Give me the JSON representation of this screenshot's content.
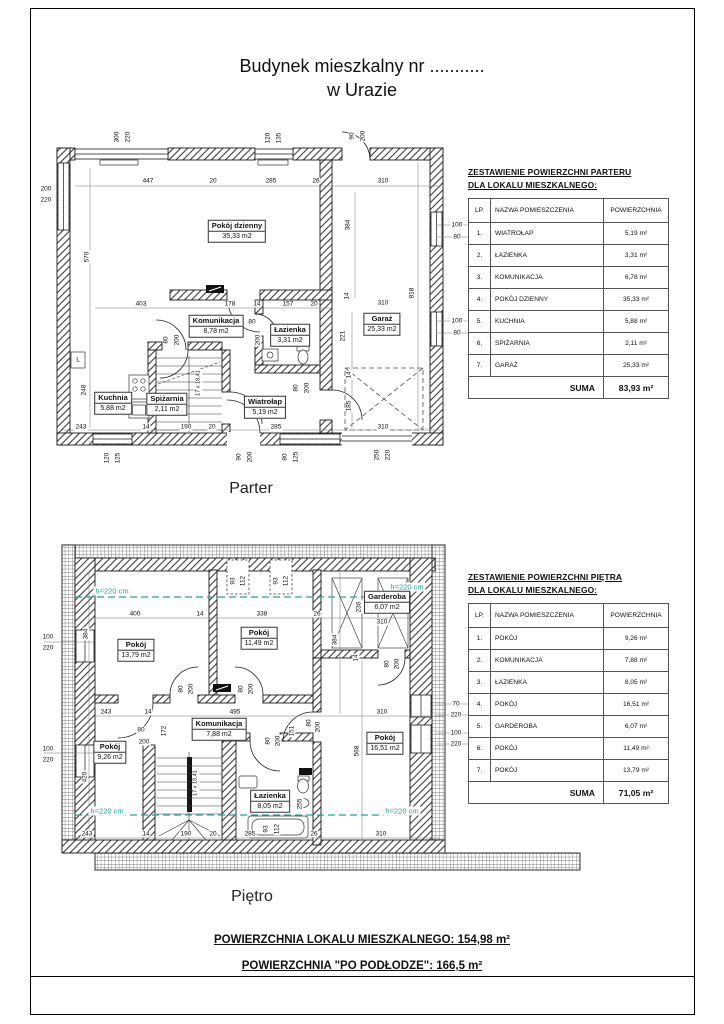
{
  "page": {
    "title_line1": "Budynek mieszkalny nr ...........",
    "title_line2": "w Urazie",
    "summary_line1": "POWIERZCHNIA LOKALU MIESZKALNEGO: 154,98 m²",
    "summary_line2": "POWIERZCHNIA \"PO PODŁODZE\": 166,5 m²"
  },
  "colors": {
    "annotation_teal": "#2aa098",
    "line_black": "#1a1a1a"
  },
  "floors": [
    {
      "id": "parter",
      "label": "Parter",
      "rooms": [
        {
          "name": "Pokój dzienny",
          "area": "35,33 m2",
          "x": 237,
          "y": 231
        },
        {
          "name": "Komunikacja",
          "area": "8,78 m2",
          "x": 216,
          "y": 326
        },
        {
          "name": "Łazienka",
          "area": "3,31 m2",
          "x": 290,
          "y": 335
        },
        {
          "name": "Garaż",
          "area": "25,33 m2",
          "x": 382,
          "y": 324
        },
        {
          "name": "Kuchnia",
          "area": "5,88 m2",
          "x": 113,
          "y": 403
        },
        {
          "name": "Spiżarnia",
          "area": "2,11 m2",
          "x": 167,
          "y": 404
        },
        {
          "name": "Wiatrołap",
          "area": "5,19 m2",
          "x": 265,
          "y": 407
        }
      ],
      "dims": [
        {
          "t": "300",
          "x": 117,
          "y": 137,
          "r": 90
        },
        {
          "t": "220",
          "x": 128,
          "y": 137,
          "r": 90
        },
        {
          "t": "120",
          "x": 268,
          "y": 138,
          "r": 90
        },
        {
          "t": "135",
          "x": 279,
          "y": 138,
          "r": 90
        },
        {
          "t": "90",
          "x": 352,
          "y": 136,
          "r": 90
        },
        {
          "t": "200",
          "x": 363,
          "y": 136,
          "r": 90
        },
        {
          "t": "447",
          "x": 148,
          "y": 181
        },
        {
          "t": "20",
          "x": 213,
          "y": 181
        },
        {
          "t": "285",
          "x": 271,
          "y": 181
        },
        {
          "t": "26",
          "x": 316,
          "y": 181
        },
        {
          "t": "310",
          "x": 383,
          "y": 181
        },
        {
          "t": "200",
          "x": 46,
          "y": 189
        },
        {
          "t": "220",
          "x": 46,
          "y": 200
        },
        {
          "t": "570",
          "x": 87,
          "y": 257,
          "r": 90
        },
        {
          "t": "100",
          "x": 457,
          "y": 225
        },
        {
          "t": "80",
          "x": 457,
          "y": 237
        },
        {
          "t": "100",
          "x": 457,
          "y": 321
        },
        {
          "t": "80",
          "x": 457,
          "y": 333
        },
        {
          "t": "384",
          "x": 348,
          "y": 225,
          "r": 90
        },
        {
          "t": "818",
          "x": 412,
          "y": 293,
          "r": 90
        },
        {
          "t": "310",
          "x": 383,
          "y": 303
        },
        {
          "t": "14",
          "x": 347,
          "y": 296,
          "r": 90
        },
        {
          "t": "221",
          "x": 343,
          "y": 336,
          "r": 90
        },
        {
          "t": "14",
          "x": 349,
          "y": 375,
          "r": 90
        },
        {
          "t": "185",
          "x": 349,
          "y": 406,
          "r": 90
        },
        {
          "t": "403",
          "x": 141,
          "y": 304
        },
        {
          "t": "178",
          "x": 230,
          "y": 304
        },
        {
          "t": "14",
          "x": 257,
          "y": 304
        },
        {
          "t": "157",
          "x": 288,
          "y": 304
        },
        {
          "t": "20",
          "x": 314,
          "y": 304
        },
        {
          "t": "80",
          "x": 252,
          "y": 322
        },
        {
          "t": "200",
          "x": 258,
          "y": 340,
          "r": 90
        },
        {
          "t": "80",
          "x": 166,
          "y": 340,
          "r": 90
        },
        {
          "t": "200",
          "x": 177,
          "y": 340,
          "r": 90
        },
        {
          "t": "248",
          "x": 84,
          "y": 390,
          "r": 90
        },
        {
          "t": "80",
          "x": 296,
          "y": 388,
          "r": 90
        },
        {
          "t": "200",
          "x": 307,
          "y": 388,
          "r": 90
        },
        {
          "t": "L",
          "x": 78,
          "y": 360
        },
        {
          "t": "243",
          "x": 81,
          "y": 427
        },
        {
          "t": "14",
          "x": 146,
          "y": 427
        },
        {
          "t": "190",
          "x": 186,
          "y": 427
        },
        {
          "t": "20",
          "x": 212,
          "y": 427
        },
        {
          "t": "285",
          "x": 276,
          "y": 427
        },
        {
          "t": "310",
          "x": 383,
          "y": 427
        },
        {
          "t": "120",
          "x": 107,
          "y": 458,
          "r": 90
        },
        {
          "t": "125",
          "x": 118,
          "y": 458,
          "r": 90
        },
        {
          "t": "90",
          "x": 239,
          "y": 457,
          "r": 90
        },
        {
          "t": "200",
          "x": 250,
          "y": 457,
          "r": 90
        },
        {
          "t": "80",
          "x": 285,
          "y": 457,
          "r": 90
        },
        {
          "t": "125",
          "x": 296,
          "y": 457,
          "r": 90
        },
        {
          "t": "250",
          "x": 377,
          "y": 455,
          "r": 90
        },
        {
          "t": "220",
          "x": 388,
          "y": 455,
          "r": 90
        }
      ],
      "notes": [
        {
          "t": "17 x 18,41",
          "x": 199,
          "y": 383,
          "r": 90
        }
      ],
      "annotations": []
    },
    {
      "id": "pietro",
      "label": "Piętro",
      "rooms": [
        {
          "name": "Pokój",
          "area": "13,79 m2",
          "x": 136,
          "y": 650
        },
        {
          "name": "Pokój",
          "area": "11,49 m2",
          "x": 259,
          "y": 638
        },
        {
          "name": "Garderoba",
          "area": "6,07 m2",
          "x": 387,
          "y": 602
        },
        {
          "name": "Komunikacja",
          "area": "7,88 m2",
          "x": 219,
          "y": 729
        },
        {
          "name": "Pokój",
          "area": "9,26 m2",
          "x": 110,
          "y": 752
        },
        {
          "name": "Łazienka",
          "area": "8,05 m2",
          "x": 270,
          "y": 801
        },
        {
          "name": "Pokój",
          "area": "16,51 m2",
          "x": 385,
          "y": 743
        }
      ],
      "dims": [
        {
          "t": "93",
          "x": 233,
          "y": 581,
          "r": 90
        },
        {
          "t": "112",
          "x": 243,
          "y": 581,
          "r": 90
        },
        {
          "t": "93",
          "x": 276,
          "y": 581,
          "r": 90
        },
        {
          "t": "112",
          "x": 286,
          "y": 581,
          "r": 90
        },
        {
          "t": "400",
          "x": 135,
          "y": 614
        },
        {
          "t": "14",
          "x": 200,
          "y": 614
        },
        {
          "t": "338",
          "x": 262,
          "y": 614
        },
        {
          "t": "26",
          "x": 317,
          "y": 614
        },
        {
          "t": "310",
          "x": 382,
          "y": 622
        },
        {
          "t": "236",
          "x": 359,
          "y": 607,
          "r": 90
        },
        {
          "t": "384",
          "x": 86,
          "y": 634,
          "r": 90
        },
        {
          "t": "384",
          "x": 335,
          "y": 640,
          "r": 90
        },
        {
          "t": "100",
          "x": 48,
          "y": 637
        },
        {
          "t": "220",
          "x": 48,
          "y": 648
        },
        {
          "t": "100",
          "x": 48,
          "y": 749
        },
        {
          "t": "220",
          "x": 48,
          "y": 760
        },
        {
          "t": "420",
          "x": 85,
          "y": 777,
          "r": 90
        },
        {
          "t": "80",
          "x": 181,
          "y": 689,
          "r": 90
        },
        {
          "t": "200",
          "x": 191,
          "y": 689,
          "r": 90
        },
        {
          "t": "80",
          "x": 241,
          "y": 689,
          "r": 90
        },
        {
          "t": "200",
          "x": 251,
          "y": 689,
          "r": 90
        },
        {
          "t": "80",
          "x": 387,
          "y": 664,
          "r": 90
        },
        {
          "t": "200",
          "x": 397,
          "y": 664,
          "r": 90
        },
        {
          "t": "14",
          "x": 356,
          "y": 658,
          "r": 90
        },
        {
          "t": "243",
          "x": 106,
          "y": 712
        },
        {
          "t": "14",
          "x": 148,
          "y": 712
        },
        {
          "t": "495",
          "x": 235,
          "y": 712
        },
        {
          "t": "310",
          "x": 382,
          "y": 712
        },
        {
          "t": "70",
          "x": 456,
          "y": 704
        },
        {
          "t": "220",
          "x": 456,
          "y": 715
        },
        {
          "t": "100",
          "x": 456,
          "y": 733
        },
        {
          "t": "220",
          "x": 456,
          "y": 744
        },
        {
          "t": "172",
          "x": 164,
          "y": 731,
          "r": 90
        },
        {
          "t": "151",
          "x": 292,
          "y": 731,
          "r": 90
        },
        {
          "t": "568",
          "x": 357,
          "y": 751,
          "r": 90
        },
        {
          "t": "80",
          "x": 141,
          "y": 730
        },
        {
          "t": "200",
          "x": 144,
          "y": 742
        },
        {
          "t": "80",
          "x": 268,
          "y": 741,
          "r": 90
        },
        {
          "t": "200",
          "x": 278,
          "y": 741,
          "r": 90
        },
        {
          "t": "80",
          "x": 309,
          "y": 723,
          "r": 90
        },
        {
          "t": "200",
          "x": 318,
          "y": 727,
          "r": 90
        },
        {
          "t": "255",
          "x": 300,
          "y": 804,
          "r": 90
        },
        {
          "t": "243",
          "x": 87,
          "y": 834
        },
        {
          "t": "14",
          "x": 146,
          "y": 834
        },
        {
          "t": "190",
          "x": 186,
          "y": 834
        },
        {
          "t": "20",
          "x": 213,
          "y": 834
        },
        {
          "t": "285",
          "x": 250,
          "y": 834
        },
        {
          "t": "93",
          "x": 266,
          "y": 829,
          "r": 90
        },
        {
          "t": "112",
          "x": 277,
          "y": 829,
          "r": 90
        },
        {
          "t": "26",
          "x": 314,
          "y": 834
        },
        {
          "t": "310",
          "x": 381,
          "y": 834
        }
      ],
      "notes": [
        {
          "t": "17 x 18,41",
          "x": 196,
          "y": 783,
          "r": 90
        }
      ],
      "annotations": [
        {
          "t": "h=220 cm",
          "x": 112,
          "y": 591
        },
        {
          "t": "h=220 cm",
          "x": 407,
          "y": 587
        },
        {
          "t": "h=220 cm",
          "x": 107,
          "y": 811
        },
        {
          "t": "h=220 cm",
          "x": 402,
          "y": 811
        }
      ]
    }
  ],
  "tables": [
    {
      "title_line1": "ZESTAWIENIE POWIERZCHNI PARTERU",
      "title_line2": "DLA LOKALU MIESZKALNEGO:",
      "headers": [
        "LP.",
        "NAZWA POMIESZCZENIA",
        "POWIERZCHNIA"
      ],
      "rows": [
        [
          "1.",
          "WIATROŁAP",
          "5,19 m²"
        ],
        [
          "2.",
          "ŁAZIENKA",
          "3,31 m²"
        ],
        [
          "3.",
          "KOMUNIKACJA",
          "6,78 m²"
        ],
        [
          "4.",
          "POKÓJ DZIENNY",
          "35,33 m²"
        ],
        [
          "5.",
          "KUCHNIA",
          "5,88 m²"
        ],
        [
          "6.",
          "SPIŻARNIA",
          "2,11 m²"
        ],
        [
          "7.",
          "GARAŻ",
          "25,33 m²"
        ]
      ],
      "suma_label": "SUMA",
      "suma_value": "83,93 m²"
    },
    {
      "title_line1": "ZESTAWIENIE POWIERZCHNI PIĘTRA",
      "title_line2": "DLA LOKALU MIESZKALNEGO:",
      "headers": [
        "LP.",
        "NAZWA POMIESZCZENIA",
        "POWIERZCHNIA"
      ],
      "rows": [
        [
          "1.",
          "POKÓJ",
          "9,26 m²"
        ],
        [
          "2.",
          "KOMUNIKACJA",
          "7,88 m²"
        ],
        [
          "3.",
          "ŁAZIENKA",
          "8,05 m²"
        ],
        [
          "4.",
          "POKÓJ",
          "16,51 m²"
        ],
        [
          "5.",
          "GARDEROBA",
          "6,07 m²"
        ],
        [
          "6.",
          "POKÓJ",
          "11,49 m²"
        ],
        [
          "7.",
          "POKÓJ",
          "13,79 m²"
        ]
      ],
      "suma_label": "SUMA",
      "suma_value": "71,05 m²"
    }
  ]
}
